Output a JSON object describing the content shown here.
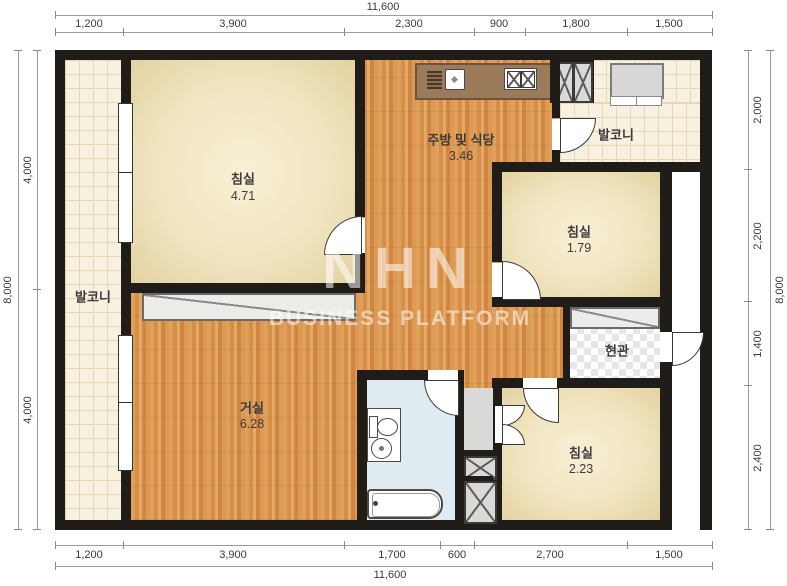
{
  "floorplan": {
    "watermark": {
      "logo": "NHN",
      "subtitle": "BUSINESS PLATFORM"
    },
    "rooms": [
      {
        "id": "bedroom-top-left",
        "name": "침실",
        "area": "4.71"
      },
      {
        "id": "kitchen-dining",
        "name": "주방 및 식당",
        "area": "3.46"
      },
      {
        "id": "balcony-left",
        "name": "발코니"
      },
      {
        "id": "balcony-top-right",
        "name": "발코니"
      },
      {
        "id": "bedroom-right",
        "name": "침실",
        "area": "1.79"
      },
      {
        "id": "entrance",
        "name": "현관"
      },
      {
        "id": "living-room",
        "name": "거실",
        "area": "6.28"
      },
      {
        "id": "bedroom-bottom-right",
        "name": "침실",
        "area": "2.23"
      }
    ],
    "dimensions": {
      "top": {
        "total": "11,600",
        "segments": [
          "1,200",
          "3,900",
          "2,300",
          "900",
          "1,800",
          "1,500"
        ]
      },
      "bottom": {
        "total": "11,600",
        "segments": [
          "1,200",
          "3,900",
          "1,700",
          "600",
          "2,700",
          "1,500"
        ]
      },
      "left": {
        "total": "8,000",
        "segments": [
          "4,000",
          "4,000"
        ]
      },
      "right": {
        "total": "8,000",
        "segments": [
          "2,000",
          "2,200",
          "1,400",
          "2,400"
        ]
      }
    },
    "colors": {
      "wall": "#201d19",
      "wood_floor": "#d9954e",
      "room_cream": "#f2e7c6",
      "bathroom": "#e0ebf2",
      "balcony_tile": "#f9f1e0",
      "counter": "#9c7b5b"
    }
  }
}
